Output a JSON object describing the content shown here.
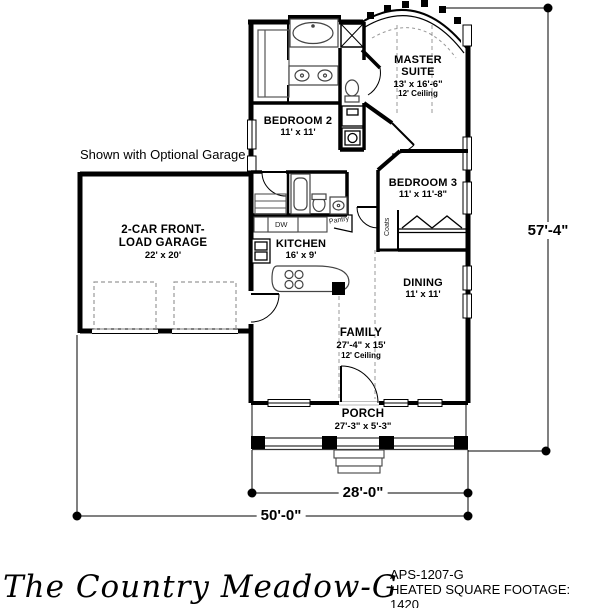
{
  "colors": {
    "ink": "#000000",
    "paper": "#ffffff"
  },
  "note": "Shown with Optional Garage",
  "rooms": {
    "master_suite": {
      "name": "MASTER SUITE",
      "dims": "13' x 16'-6\"",
      "ceiling": "12' Ceiling"
    },
    "bedroom_2": {
      "name": "BEDROOM 2",
      "dims": "11' x 11'"
    },
    "bedroom_3": {
      "name": "BEDROOM 3",
      "dims": "11' x 11'-8\""
    },
    "kitchen": {
      "name": "KITCHEN",
      "dims": "16' x 9'"
    },
    "dining": {
      "name": "DINING",
      "dims": "11' x 11'"
    },
    "family": {
      "name": "FAMILY",
      "dims": "27'-4\" x 15'",
      "ceiling": "12' Ceiling"
    },
    "porch": {
      "name": "PORCH",
      "dims": "27'-3\" x 5'-3\""
    },
    "garage": {
      "name": "2-CAR FRONT-LOAD GARAGE",
      "dims": "22' x 20'"
    }
  },
  "fixtures": {
    "dishwasher": "DW",
    "pantry": "Pantry",
    "coats": "Coats"
  },
  "dimensions": {
    "height": "57'-4\"",
    "porch_width": "28'-0\"",
    "overall_width": "50'-0\""
  },
  "footer": {
    "title": "The Country Meadow-G",
    "plan_number": "APS-1207-G",
    "footage_label": "HEATED SQUARE FOOTAGE:",
    "footage_value": "1420"
  }
}
